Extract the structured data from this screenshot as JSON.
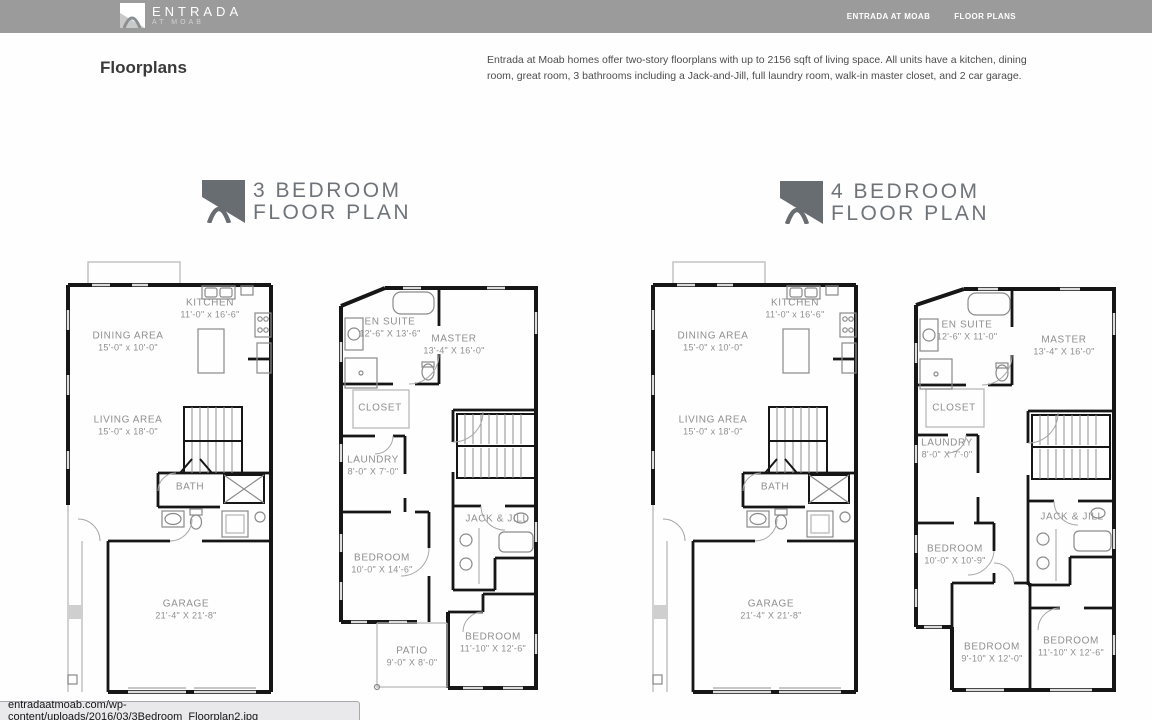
{
  "header": {
    "logo": {
      "line1": "ENTRADA",
      "line2": "AT MOAB"
    },
    "nav": [
      {
        "label": "ENTRADA AT MOAB"
      },
      {
        "label": "FLOOR PLANS"
      }
    ]
  },
  "intro": {
    "heading": "Floorplans",
    "description": "Entrada at Moab homes offer two-story floorplans with up to 2156 sqft of living space.  All units have a kitchen, dining room, great room, 3 bathrooms including a Jack-and-Jill, full laundry room, walk-in master closet, and 2 car garage."
  },
  "sections": {
    "three_bedroom": {
      "title_line1": "3 BEDROOM",
      "title_line2": "FLOOR PLAN"
    },
    "four_bedroom": {
      "title_line1": "4 BEDROOM",
      "title_line2": "FLOOR PLAN"
    }
  },
  "plans": {
    "first_floor": {
      "rooms": {
        "kitchen": {
          "label": "KITCHEN",
          "dims": "11'-0\" x 16'-6\""
        },
        "dining": {
          "label": "DINING AREA",
          "dims": "15'-0\" x 10'-0\""
        },
        "living": {
          "label": "LIVING AREA",
          "dims": "15'-0\" x 18'-0\""
        },
        "bath": {
          "label": "BATH"
        },
        "garage": {
          "label": "GARAGE",
          "dims": "21'-4\" X 21'-8\""
        }
      }
    },
    "second_floor_3br": {
      "rooms": {
        "ensuite": {
          "label": "EN SUITE",
          "dims": "12'-6\" X 13'-6\""
        },
        "master": {
          "label": "MASTER",
          "dims": "13'-4\" X 16'-0\""
        },
        "closet": {
          "label": "CLOSET"
        },
        "laundry": {
          "label": "LAUNDRY",
          "dims": "8'-0\" X 7'-0\""
        },
        "jackjill": {
          "label": "JACK & JILL"
        },
        "bedroom1": {
          "label": "BEDROOM",
          "dims": "10'-0\" X 14'-6\""
        },
        "patio": {
          "label": "PATIO",
          "dims": "9'-0\" X 8'-0\""
        },
        "bedroom2": {
          "label": "BEDROOM",
          "dims": "11'-10\" X 12'-6\""
        }
      }
    },
    "second_floor_4br": {
      "rooms": {
        "ensuite": {
          "label": "EN SUITE",
          "dims": "12'-6\" X 11'-0\""
        },
        "master": {
          "label": "MASTER",
          "dims": "13'-4\" X 16'-0\""
        },
        "closet": {
          "label": "CLOSET"
        },
        "laundry": {
          "label": "LAUNDRY",
          "dims": "8'-0\" X 7'-0\""
        },
        "jackjill": {
          "label": "JACK & JILL"
        },
        "bedroom1": {
          "label": "BEDROOM",
          "dims": "10'-0\" X 10'-9\""
        },
        "bedroom2": {
          "label": "BEDROOM",
          "dims": "9'-10\" X 12'-0\""
        },
        "bedroom3": {
          "label": "BEDROOM",
          "dims": "11'-10\" X 12'-6\""
        }
      }
    }
  },
  "statusbar": {
    "url": "entradaatmoab.com/wp-content/uploads/2016/03/3Bedroom_Floorplan2.jpg"
  },
  "colors": {
    "header_bg": "#9b9b9b",
    "title_text": "#6f747a",
    "wall": "#161616",
    "room_label": "#8f8f8f",
    "status_bg": "#e9e9ec"
  }
}
